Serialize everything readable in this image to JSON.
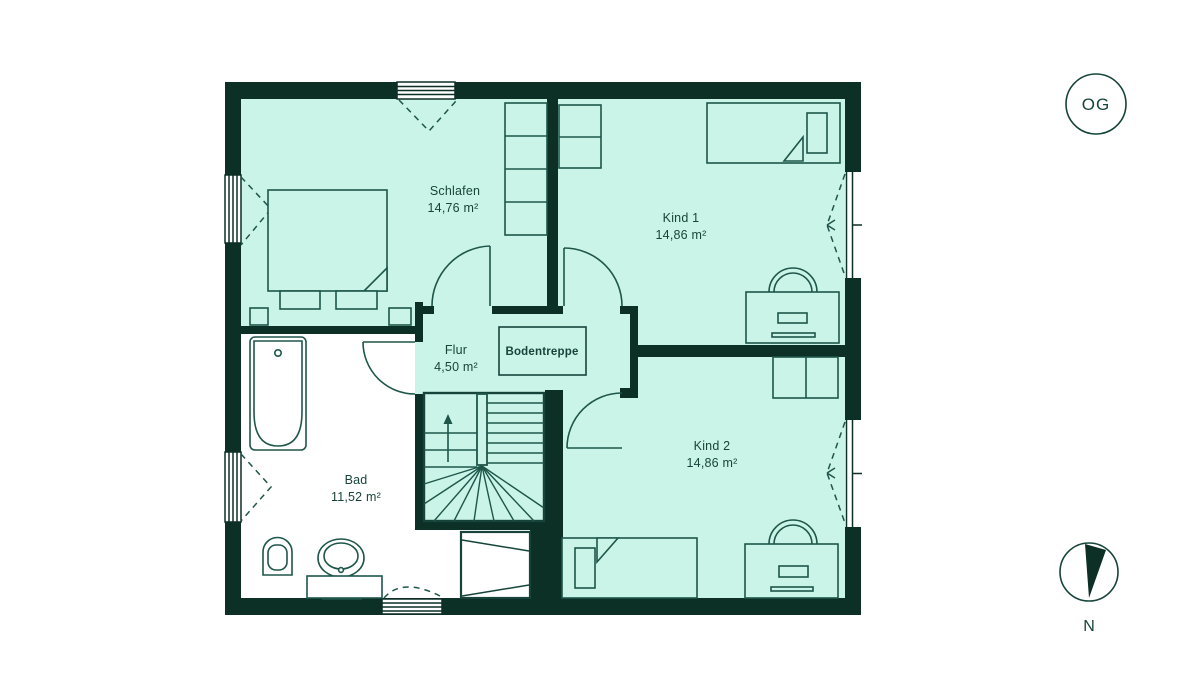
{
  "floorplan": {
    "badge": "OG",
    "compass_label": "N",
    "attic_stairs_label": "Bodentreppe",
    "rooms": [
      {
        "name": "Schlafen",
        "area": "14,76 m²"
      },
      {
        "name": "Kind 1",
        "area": "14,86 m²"
      },
      {
        "name": "Kind 2",
        "area": "14,86 m²"
      },
      {
        "name": "Bad",
        "area": "11,52 m²"
      },
      {
        "name": "Flur",
        "area": "4,50 m²"
      }
    ],
    "colors": {
      "wall": "#0c2f26",
      "room_fill": "#cbf4e8",
      "bath_fill": "#ffffff",
      "line": "#1e564a",
      "text": "#17443a"
    }
  }
}
